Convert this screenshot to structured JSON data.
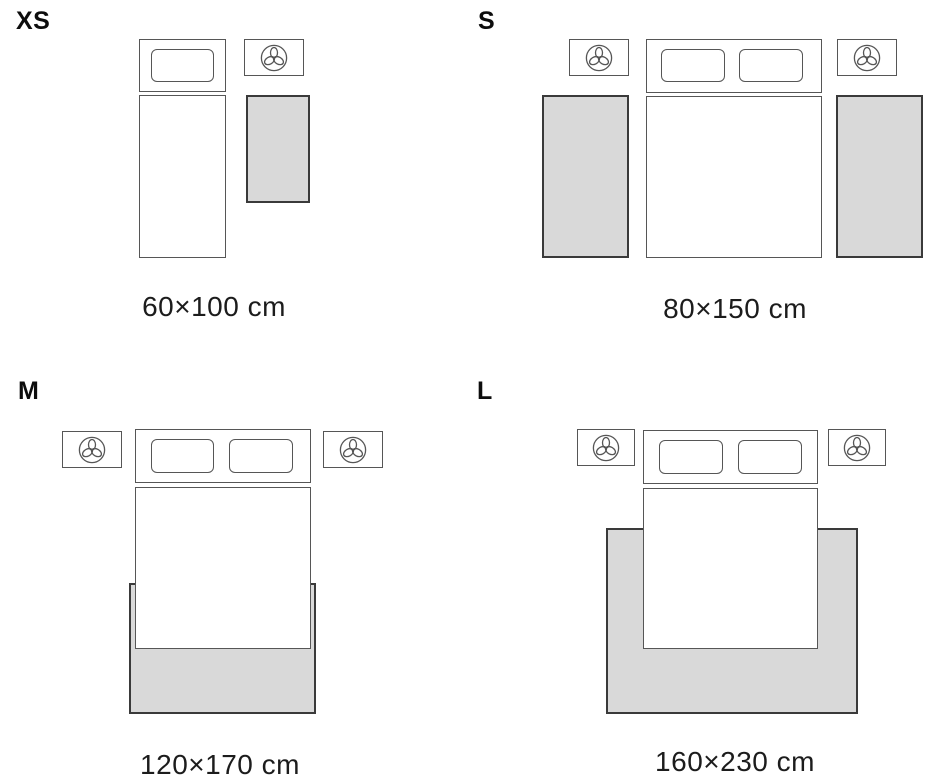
{
  "title": "Rug size guide bedroom layouts",
  "colors": {
    "background": "#ffffff",
    "rug_fill": "#d9d9d9",
    "rug_border": "#3a3a3a",
    "furniture_border": "#565656",
    "dimension_text": "#1c1c1c",
    "size_label_text": "#0d0d0d"
  },
  "sizes": [
    {
      "label": "XS",
      "dimensions": "60×100 cm"
    },
    {
      "label": "S",
      "dimensions": "80×150 cm"
    },
    {
      "label": "M",
      "dimensions": "120×170 cm"
    },
    {
      "label": "L",
      "dimensions": "160×230 cm"
    }
  ],
  "icons": {
    "nightstand_decor": "plant-icon"
  }
}
